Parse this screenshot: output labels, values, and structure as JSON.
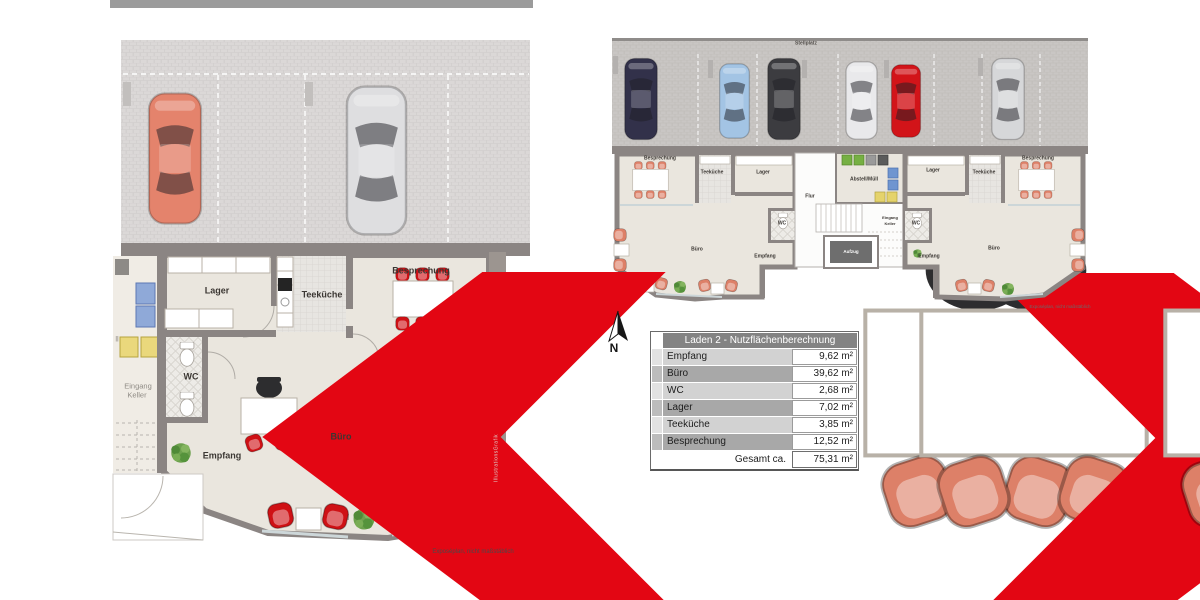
{
  "detail_plan": {
    "labels": {
      "lager": "Lager",
      "teekueche": "Teeküche",
      "besprechung": "Besprechung",
      "wc": "WC",
      "buero": "Büro",
      "empfang": "Empfang",
      "eingang": "Eingang",
      "keller": "Keller",
      "fragment": "ll"
    },
    "disclaimer": "Exposéplan, nicht maßstäblich",
    "watermark": "IllustrationsGrafik"
  },
  "overview_plan": {
    "parking_label": "Stellplatz",
    "unit_left": {
      "besprechung": "Besprechung",
      "teekueche": "Teeküche",
      "lager": "Lager",
      "wc": "WC",
      "buero": "Büro",
      "empfang": "Empfang"
    },
    "core": {
      "flur": "Flur",
      "abstell": "Abstell/Müll",
      "aufzug": "Aufzug",
      "eingang": "Eingang",
      "keller": "Keller"
    },
    "unit_right": {
      "lager": "Lager",
      "teekueche": "Teeküche",
      "besprechung": "Besprechung",
      "wc": "WC",
      "buero": "Büro",
      "empfang": "Empfang"
    },
    "disclaimer": "Exposéplan, nicht maßstäblich"
  },
  "compass": {
    "label": "N"
  },
  "table": {
    "title": "Laden 2 - Nutzflächenberechnung",
    "rows": [
      {
        "label": "Empfang",
        "value": "9,62 m²"
      },
      {
        "label": "Büro",
        "value": "39,62 m²"
      },
      {
        "label": "WC",
        "value": "2,68 m²"
      },
      {
        "label": "Lager",
        "value": "7,02 m²"
      },
      {
        "label": "Teeküche",
        "value": "3,85 m²"
      },
      {
        "label": "Besprechung",
        "value": "12,52 m²"
      }
    ],
    "total_label": "Gesamt ca.",
    "total_value": "75,31 m²"
  },
  "colors": {
    "accent_red": "#e30613",
    "furniture_red": "#cf1115",
    "furniture_salmon": "#dd8068",
    "wall": "#8b8583",
    "interior": "#eae6de",
    "table_header": "#838383",
    "row_dark": "#a8a8a8",
    "row_light": "#d2d2d2"
  }
}
